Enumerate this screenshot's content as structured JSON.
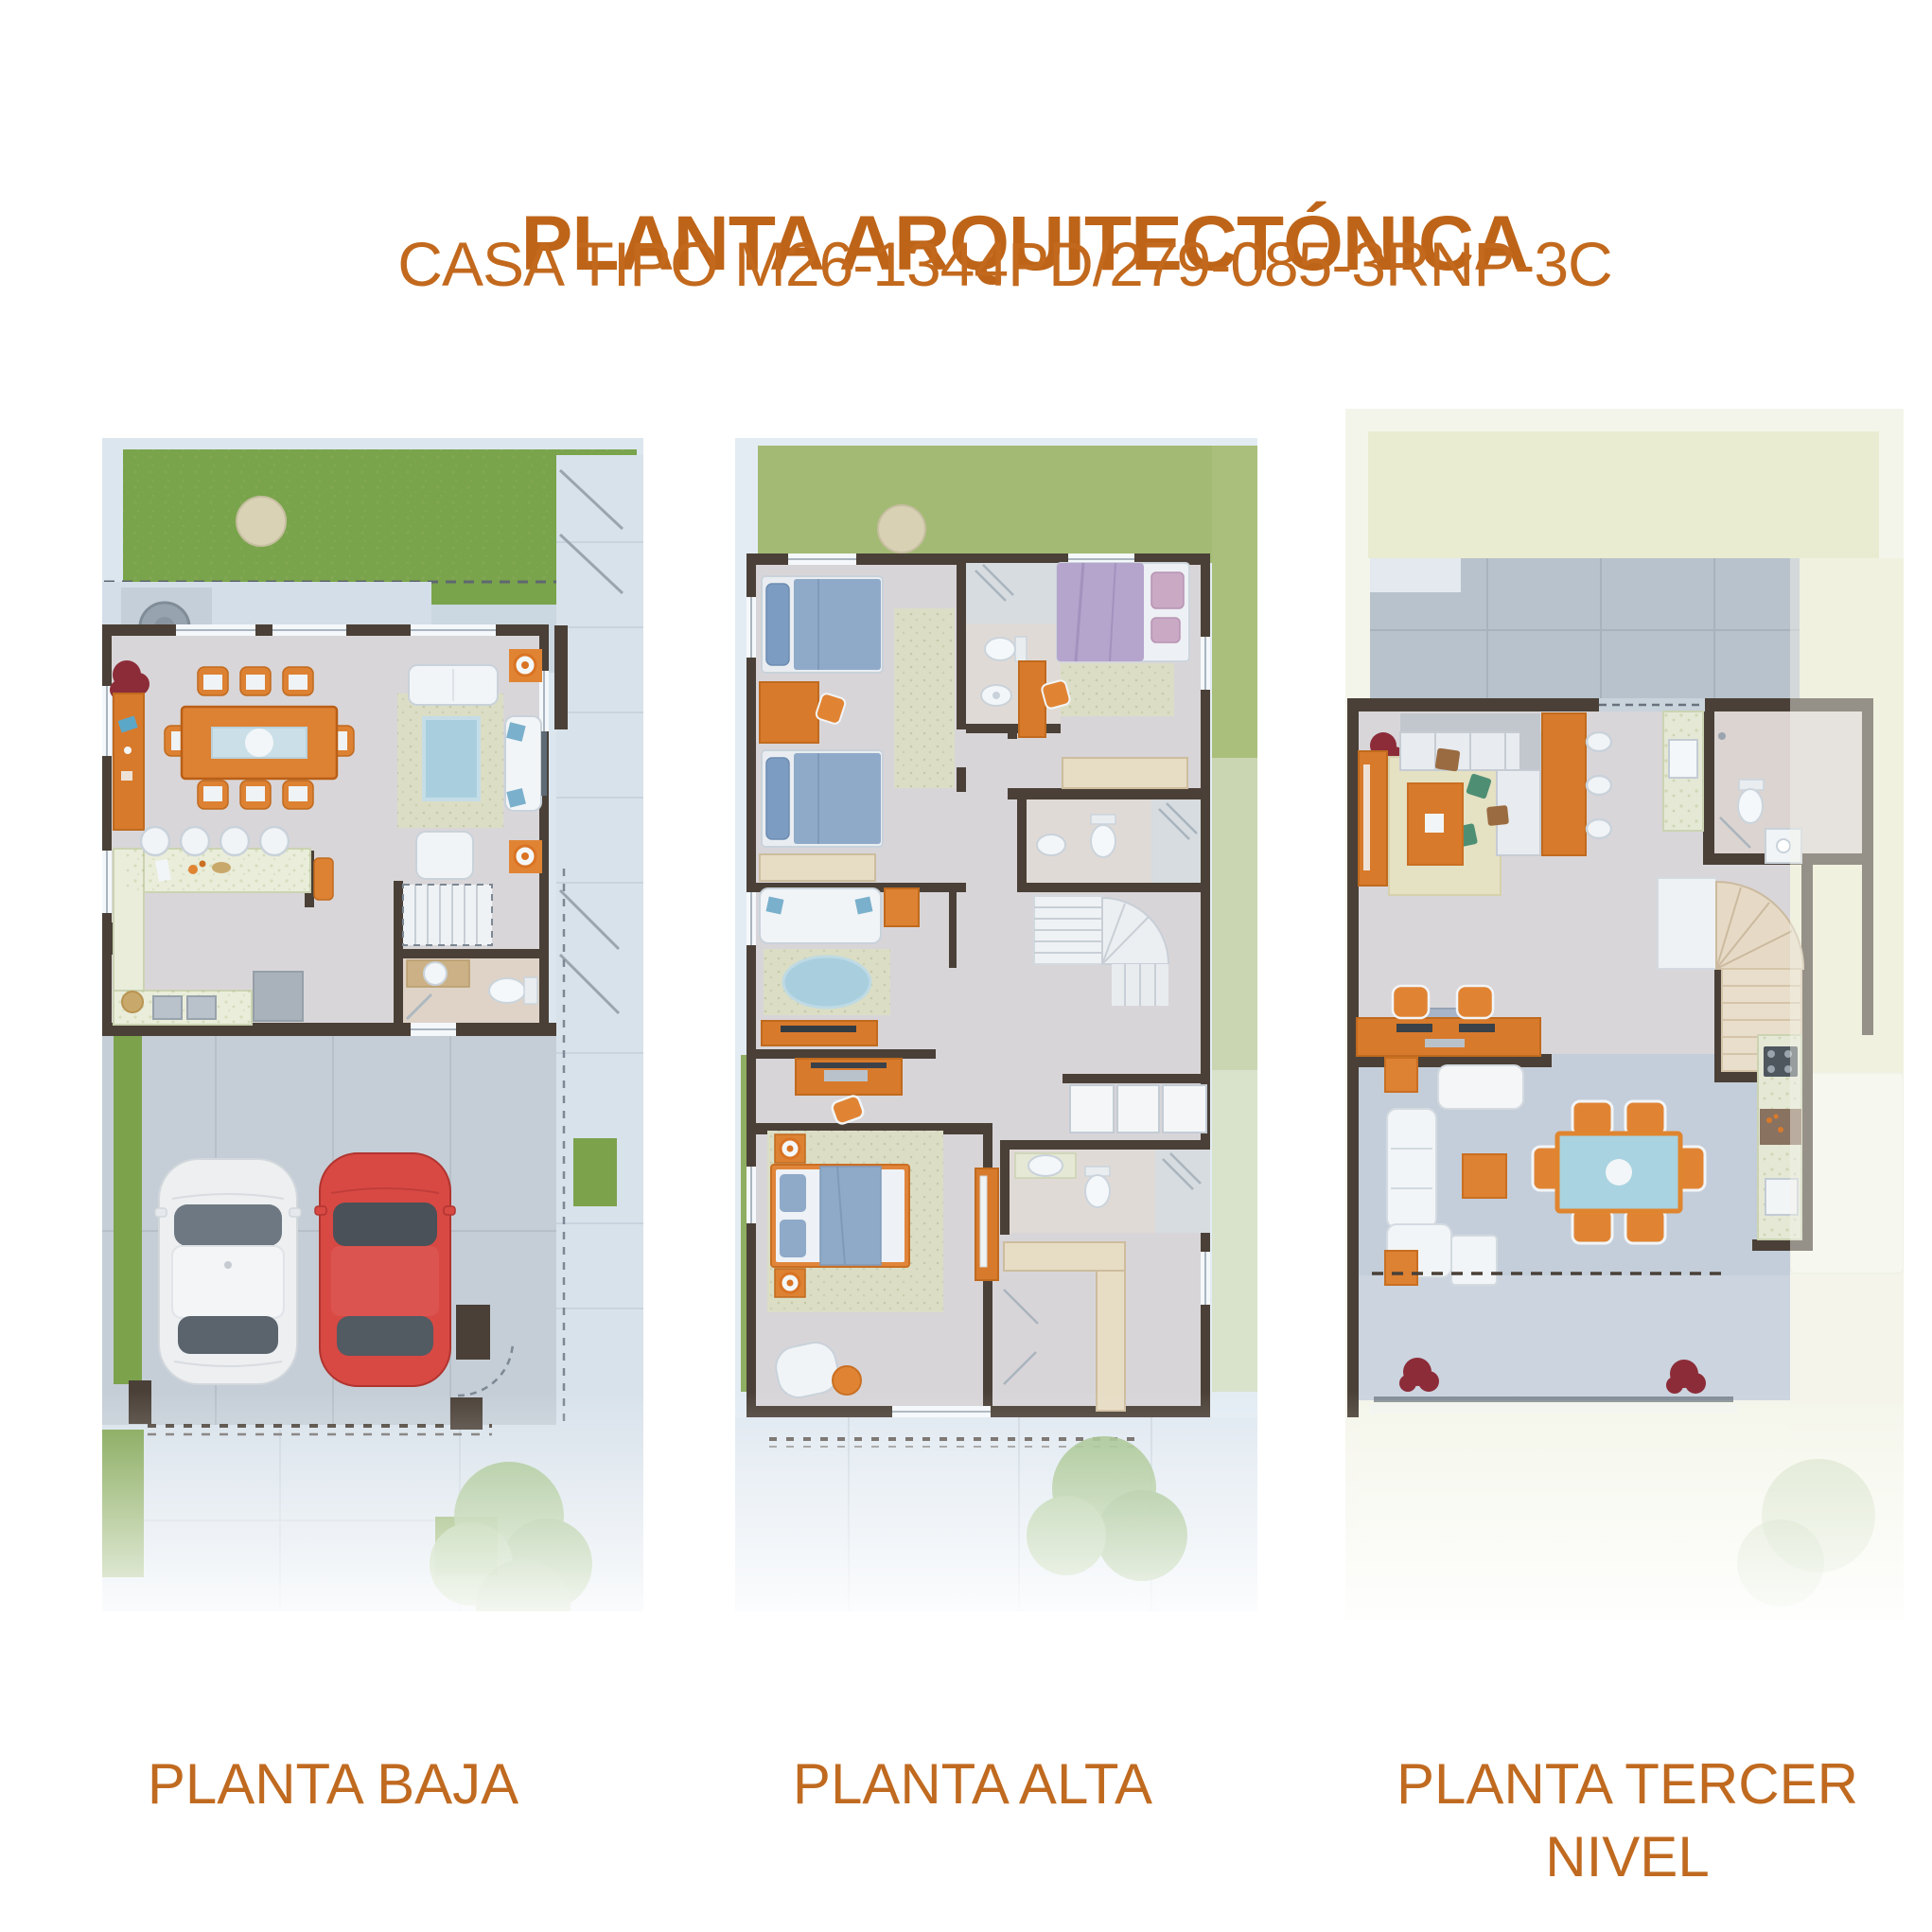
{
  "header": {
    "title": "PLANTA ARQUITECTÓNICA",
    "subtitle": "CASA TIPO M26-1344PD/279-085-3RNP-3C"
  },
  "plans": [
    {
      "id": "planta-baja",
      "label": "PLANTA BAJA",
      "features": [
        "backyard-lawn",
        "dining-room",
        "living-room",
        "kitchen",
        "half-bathroom",
        "staircase",
        "two-car-garage",
        "driveway",
        "front-sidewalk"
      ]
    },
    {
      "id": "planta-alta",
      "label": "PLANTA ALTA",
      "features": [
        "twin-bedroom",
        "secondary-bedroom",
        "two-bathrooms",
        "tv-room",
        "study-desk",
        "staircase",
        "master-bedroom",
        "walk-in-closet"
      ]
    },
    {
      "id": "planta-tercer-nivel",
      "label": "PLANTA TERCER NIVEL",
      "features": [
        "family-room",
        "wet-bar",
        "bathroom",
        "staircase",
        "study-desk",
        "roof-terrace",
        "outdoor-dining",
        "outdoor-kitchen",
        "lounge"
      ]
    }
  ],
  "palette": {
    "accent_orange": "#BE6418",
    "subtitle_orange": "#C2691D",
    "label_orange": "#C06A20",
    "wall_brown": "#4A4037",
    "grass_green": "#79A44B",
    "grass_pale": "#A3BA74",
    "grass_wash": "#E9ECD1",
    "floor_gray": "#D9D6D9",
    "concrete": "#C5CED7",
    "sidewalk": "#DCE6EF",
    "furniture_orange": "#DD8133",
    "wood_orange": "#D87A2B",
    "car_red": "#D84944",
    "car_white": "#EDEFF1",
    "bed_blue": "#8FAAC9",
    "bed_purple": "#B5A5CC",
    "rug_blue": "#A9CFDF",
    "rug_speckle": "#DBDEC5",
    "counter_speckle": "#E9EDDA",
    "stairs_beige": "#E6DAC6"
  }
}
